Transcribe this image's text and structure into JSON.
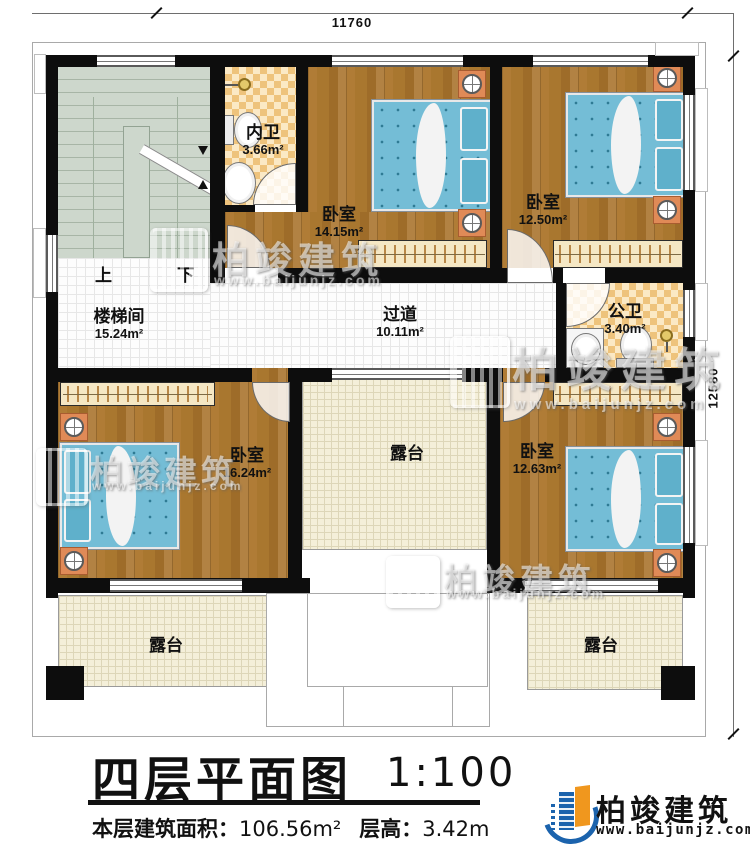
{
  "plan": {
    "dimensions": {
      "width_mm": "11760",
      "height_mm": "12580"
    },
    "stairs": {
      "up": "上",
      "down": "下"
    },
    "rooms": {
      "inner_bath": {
        "name": "内卫",
        "area": "3.66m²"
      },
      "bedroom_top_left": {
        "name": "卧室",
        "area": "14.15m²"
      },
      "bedroom_top_right": {
        "name": "卧室",
        "area": "12.50m²"
      },
      "stairwell": {
        "name": "楼梯间",
        "area": "15.24m²"
      },
      "corridor": {
        "name": "过道",
        "area": "10.11m²"
      },
      "public_bath": {
        "name": "公卫",
        "area": "3.40m²"
      },
      "bedroom_bottom_left": {
        "name": "卧室",
        "area": "16.24m²"
      },
      "terrace_middle": {
        "name": "露台"
      },
      "bedroom_bottom_right": {
        "name": "卧室",
        "area": "12.63m²"
      },
      "terrace_bottom_left": {
        "name": "露台"
      },
      "terrace_bottom_right": {
        "name": "露台"
      }
    }
  },
  "title_block": {
    "title": "四层平面图",
    "scale": "1:100",
    "area_label": "本层建筑面积：",
    "area_value": "106.56m²",
    "height_label": "层高：",
    "height_value": "3.42m"
  },
  "branding": {
    "company": "柏竣建筑",
    "website": "www.baijunjz.com"
  },
  "watermark": {
    "company": "柏竣建筑",
    "website": "www.baijunjz.com"
  },
  "colors": {
    "wall": "#0d0d0d",
    "wood": "#a9772f",
    "checker_light": "#fbe9c5",
    "checker_dark": "#eec37c",
    "stair": "#ccd6cb",
    "terrace": "#f4efd9",
    "bed": "#74bdd6",
    "nightstand": "#e08a57",
    "logo_blue": "#1b63ad",
    "logo_orange": "#f0971e"
  }
}
